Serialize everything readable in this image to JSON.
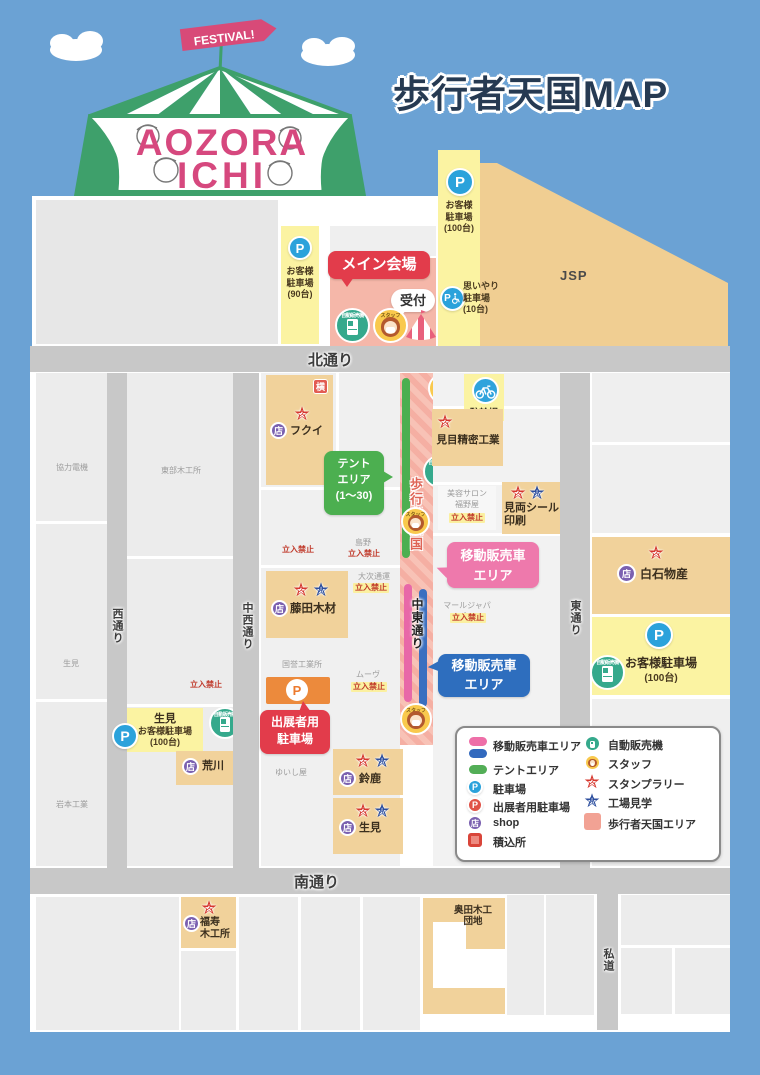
{
  "header": {
    "title": "歩行者天国MAP"
  },
  "logo": {
    "flag": "FESTIVAL!",
    "line1": "AOZORA",
    "line2": "ICHI"
  },
  "roads": {
    "north": "北通り",
    "south": "南通り",
    "west": "西通り",
    "mid_west": "中西通り",
    "mid_east": "中東通り",
    "east": "東通り",
    "private_road": "私道",
    "pedestrian": "歩行者天国"
  },
  "venue": {
    "main": "メイン会場",
    "reception": "受付",
    "tent_area": "テント\nエリア\n(1〜30)",
    "mobile_vendor": "移動販売車\nエリア",
    "exhibitor_parking": "出展者用\n駐車場",
    "bicycle_parking": "駐輪場"
  },
  "parking": {
    "left": "お客様\n駐車場\n(90台)",
    "top": "お客様\n駐車場\n(100台)",
    "omoiyari": "思いやり\n駐車場\n(10台)",
    "ikemi_name": "生見",
    "ikemi_sub": "お客様駐車場",
    "ikemi_cap": "(100台)",
    "right_name": "お客様駐車場",
    "right_cap": "(100台)"
  },
  "buildings": {
    "jsp": "JSP",
    "fukui": "フクイ",
    "memi": "見目精密工業",
    "miryo": "見両シール\n印刷",
    "fujita": "藤田木材",
    "shiraishi": "白石物産",
    "arakawa": "荒川",
    "suzuka": "鈴鹿",
    "ikemi": "生見",
    "fukuju": "福寿\n木工所",
    "okuda": "奥田木工\n団地",
    "kyoryoku": "協力電機",
    "tobu": "東部木工所",
    "ikemi_small": "生見",
    "iwamoto": "岩本工業",
    "salon": "美容サロン",
    "fukunoya": "福野屋",
    "mar_japan": "マールジャパン",
    "shimano": "島野",
    "daiji": "大次通運",
    "muv": "ムーヴ",
    "kokuyo": "国誉工業所",
    "yuishiya": "ゆいし屋"
  },
  "labels": {
    "keep_out": "立入禁止",
    "staff": "スタッフ",
    "vending": "自動販売機"
  },
  "icons": {
    "p": "P",
    "shop": "店",
    "loading": "横",
    "stamp": "ス",
    "factory": "見"
  },
  "legend": {
    "left": [
      {
        "label": "移動販売車エリア"
      },
      {
        "label": "テントエリア"
      },
      {
        "label": "駐車場"
      },
      {
        "label": "出展者用駐車場"
      },
      {
        "label": "shop"
      },
      {
        "label": "積込所"
      }
    ],
    "right": [
      {
        "label": "自動販売機"
      },
      {
        "label": "スタッフ"
      },
      {
        "label": "スタンプラリー"
      },
      {
        "label": "工場見学"
      },
      {
        "label": "歩行者天国エリア"
      }
    ]
  },
  "colors": {
    "background": "#6BA2D4",
    "road": "#C8C8C8",
    "building_tan": "#F1D29B",
    "parking_yellow": "#FBF3A2",
    "pedestrian_pink": "#F5B0A4",
    "accent_red": "#E23C4B",
    "bubble_pink": "#EE79AC",
    "bubble_blue": "#2E6EBE",
    "bubble_green": "#4CAF50",
    "p_blue": "#2BA2DB",
    "shop_purple": "#7B61B0",
    "star_red": "#D6372E",
    "star_blue": "#2C4E9E",
    "vending_teal": "#35A98C",
    "staff_yellow": "#F9C94D"
  }
}
